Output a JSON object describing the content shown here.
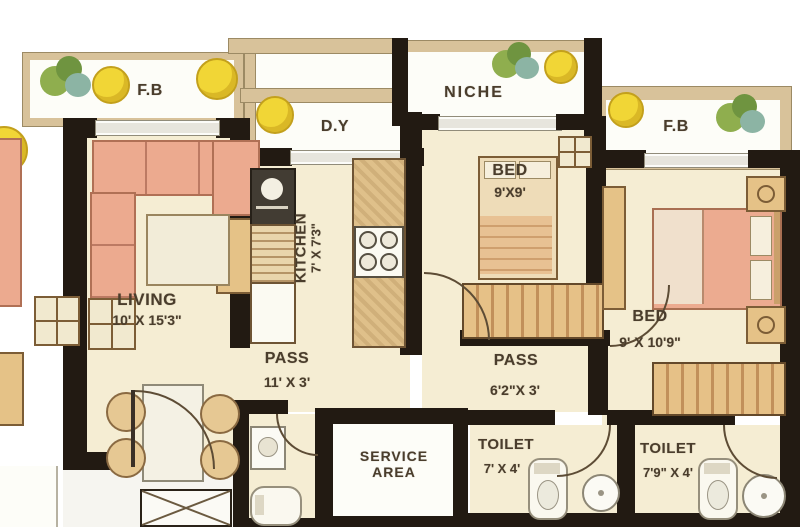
{
  "palette": {
    "wall": "#221a12",
    "floor": "#f5edd3",
    "balcony_white": "#fdfdf8",
    "frame_tan": "#d8c29a",
    "furniture_wood": "#e5c287",
    "furniture_salmon": "#ecaa8f",
    "plant_yellow": "#f1d636",
    "plant_green": "#7f9f44",
    "label_text": "#4a3d2c"
  },
  "rooms": {
    "fb_left": {
      "label": "F.B"
    },
    "dy": {
      "label": "D.Y"
    },
    "niche": {
      "label": "NICHE"
    },
    "fb_right": {
      "label": "F.B"
    },
    "living": {
      "label": "LIVING",
      "dims": "10' X 15'3\""
    },
    "kitchen": {
      "label": "KITCHEN",
      "dims": "7' X 7'3\""
    },
    "bed_small": {
      "label": "BED",
      "dims": "9'X9'"
    },
    "bed_large": {
      "label": "BED",
      "dims": "9' X 10'9\""
    },
    "pass_main": {
      "label": "PASS",
      "dims": "11' X 3'"
    },
    "pass_bed": {
      "label": "PASS",
      "dims": "6'2\"X 3'"
    },
    "service": {
      "label": "SERVICE AREA"
    },
    "toilet_common": {
      "label": "TOILET",
      "dims": "7' X 4'"
    },
    "toilet_attached": {
      "label": "TOILET",
      "dims": "7'9\" X 4'"
    }
  }
}
